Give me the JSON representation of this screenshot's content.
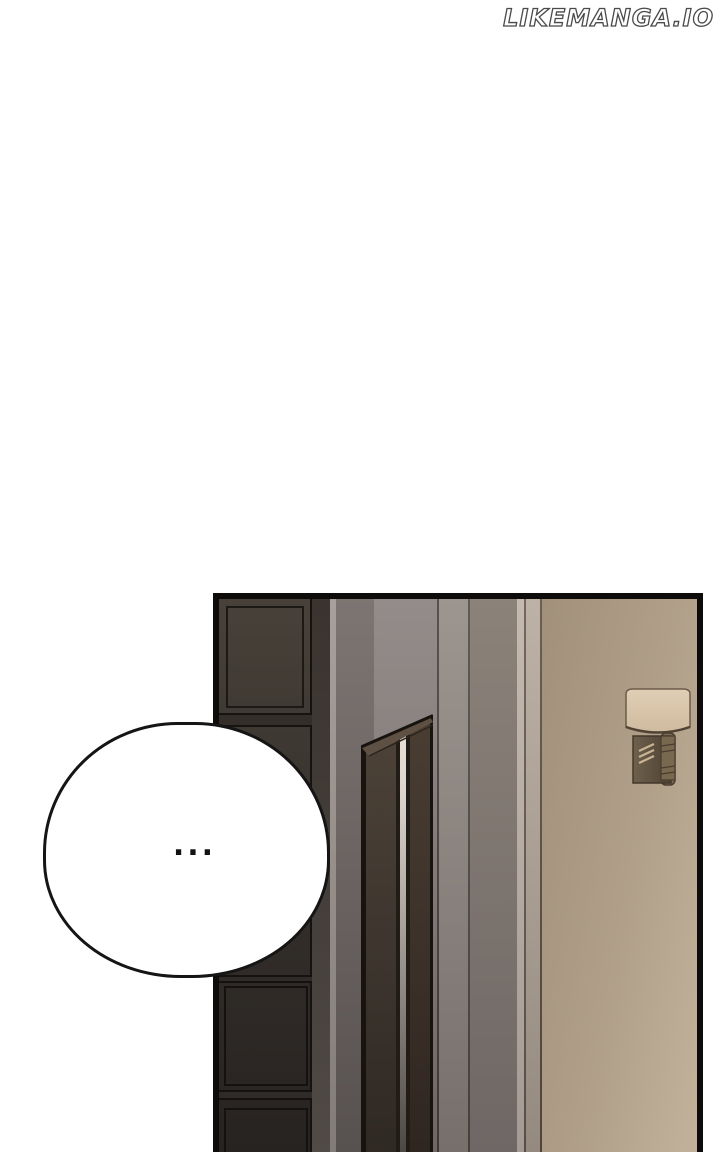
{
  "watermark": {
    "text": "LIKEMANGA.IO"
  },
  "panel": {
    "speech_bubble": {
      "text": "..."
    }
  },
  "colors": {
    "page_bg": "#ffffff",
    "watermark_fill": "#ffffff",
    "watermark_outline": "#4a4a4a",
    "panel_border": "#0e0c0a",
    "bubble_fill": "#ffffff",
    "bubble_outline": "#151515",
    "wall_beige_dark": "#a1907a",
    "wall_beige_mid": "#b1a089",
    "wall_beige_light": "#c2b29b",
    "cabinet_dark": "#272321",
    "door_frame_brown": "#473e35",
    "lamp_shade_cream": "#dccab0",
    "lamp_bracket_brown": "#6e604b"
  }
}
